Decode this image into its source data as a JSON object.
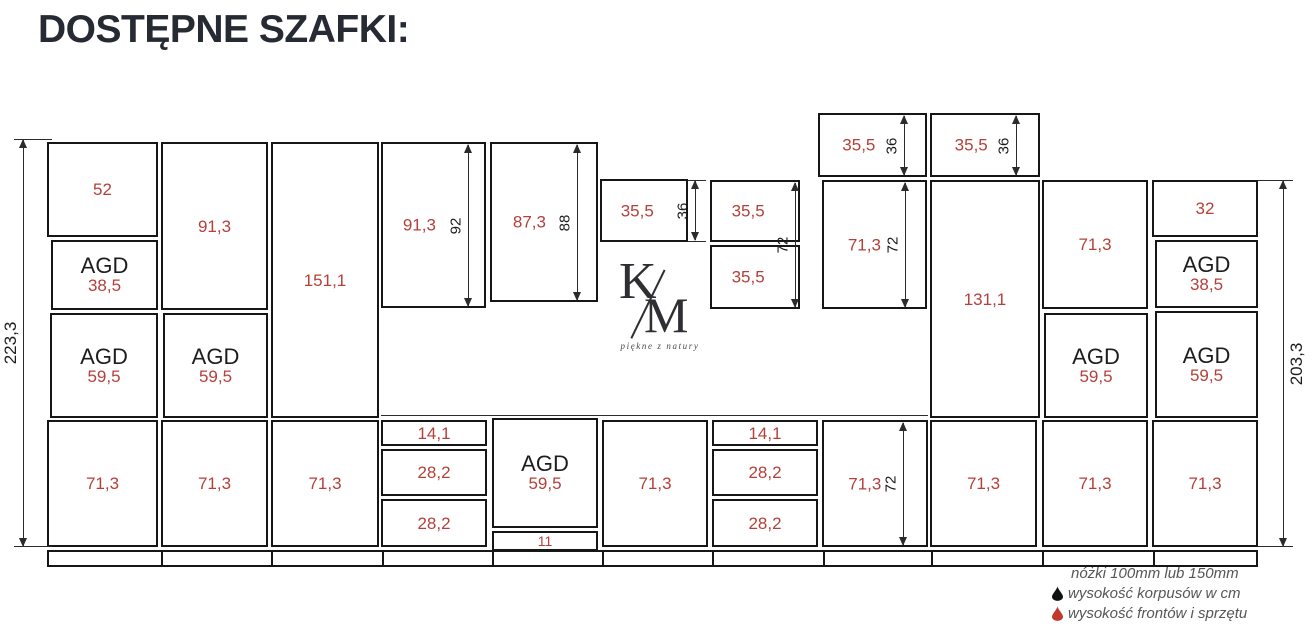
{
  "title": "DOSTĘPNE SZAFKI:",
  "colors": {
    "value_red": "#b5403a",
    "line_black": "#161616",
    "title_color": "#262a33",
    "legend_gray": "#565656",
    "legend_drop_black": "#111111",
    "legend_drop_red": "#c0392b"
  },
  "logo": {
    "k": "K",
    "m": "M",
    "tagline": "piękne z natury"
  },
  "legend": {
    "line1": "nóżki 100mm lub 150mm",
    "line2": "wysokość korpusów w cm",
    "line3": "wysokość frontów i sprzętu"
  },
  "diagram": {
    "agd_label": "AGD",
    "boxes": [
      {
        "x": 47,
        "y": 142,
        "w": 111,
        "h": 95,
        "v": "52"
      },
      {
        "x": 51,
        "y": 240,
        "w": 107,
        "h": 70,
        "agd": true,
        "v": "38,5"
      },
      {
        "x": 50,
        "y": 313,
        "w": 108,
        "h": 105,
        "agd": true,
        "v": "59,5"
      },
      {
        "x": 161,
        "y": 142,
        "w": 107,
        "h": 168,
        "v": "91,3"
      },
      {
        "x": 163,
        "y": 313,
        "w": 105,
        "h": 105,
        "agd": true,
        "v": "59,5"
      },
      {
        "x": 271,
        "y": 142,
        "w": 108,
        "h": 276,
        "v": "151,1"
      },
      {
        "x": 381,
        "y": 142,
        "w": 105,
        "h": 166,
        "v": "91,3",
        "vx": 0.36
      },
      {
        "x": 490,
        "y": 142,
        "w": 108,
        "h": 160,
        "v": "87,3",
        "vx": 0.36
      },
      {
        "x": 600,
        "y": 179,
        "w": 88,
        "h": 63,
        "v": "35,5",
        "vx": 0.42
      },
      {
        "x": 710,
        "y": 180,
        "w": 90,
        "h": 62,
        "v": "35,5",
        "vx": 0.42
      },
      {
        "x": 710,
        "y": 245,
        "w": 90,
        "h": 64,
        "v": "35,5",
        "vx": 0.42
      },
      {
        "x": 822,
        "y": 180,
        "w": 105,
        "h": 129,
        "v": "71,3",
        "vx": 0.4
      },
      {
        "x": 818,
        "y": 113,
        "w": 109,
        "h": 64,
        "v": "35,5",
        "vx": 0.37
      },
      {
        "x": 930,
        "y": 113,
        "w": 110,
        "h": 64,
        "v": "35,5",
        "vx": 0.37
      },
      {
        "x": 930,
        "y": 180,
        "w": 110,
        "h": 238,
        "v": "131,1"
      },
      {
        "x": 1042,
        "y": 180,
        "w": 106,
        "h": 129,
        "v": "71,3"
      },
      {
        "x": 1044,
        "y": 313,
        "w": 104,
        "h": 105,
        "agd": true,
        "v": "59,5"
      },
      {
        "x": 1152,
        "y": 180,
        "w": 106,
        "h": 57,
        "v": "32"
      },
      {
        "x": 1155,
        "y": 240,
        "w": 103,
        "h": 68,
        "agd": true,
        "v": "38,5"
      },
      {
        "x": 1155,
        "y": 311,
        "w": 103,
        "h": 107,
        "agd": true,
        "v": "59,5"
      },
      {
        "x": 47,
        "y": 420,
        "w": 111,
        "h": 127,
        "v": "71,3"
      },
      {
        "x": 161,
        "y": 420,
        "w": 107,
        "h": 127,
        "v": "71,3"
      },
      {
        "x": 271,
        "y": 420,
        "w": 108,
        "h": 127,
        "v": "71,3"
      },
      {
        "x": 381,
        "y": 420,
        "w": 106,
        "h": 26,
        "v": "14,1"
      },
      {
        "x": 381,
        "y": 449,
        "w": 106,
        "h": 47,
        "v": "28,2"
      },
      {
        "x": 381,
        "y": 499,
        "w": 106,
        "h": 48,
        "v": "28,2"
      },
      {
        "x": 492,
        "y": 418,
        "w": 106,
        "h": 110,
        "agd": true,
        "v": "59,5"
      },
      {
        "x": 492,
        "y": 531,
        "w": 106,
        "h": 20,
        "v": "11",
        "small": true
      },
      {
        "x": 602,
        "y": 420,
        "w": 106,
        "h": 127,
        "v": "71,3"
      },
      {
        "x": 712,
        "y": 420,
        "w": 106,
        "h": 26,
        "v": "14,1"
      },
      {
        "x": 712,
        "y": 449,
        "w": 106,
        "h": 47,
        "v": "28,2"
      },
      {
        "x": 712,
        "y": 499,
        "w": 106,
        "h": 48,
        "v": "28,2"
      },
      {
        "x": 822,
        "y": 420,
        "w": 106,
        "h": 127,
        "v": "71,3",
        "vx": 0.4
      },
      {
        "x": 930,
        "y": 420,
        "w": 107,
        "h": 127,
        "v": "71,3"
      },
      {
        "x": 1042,
        "y": 420,
        "w": 106,
        "h": 127,
        "v": "71,3"
      },
      {
        "x": 1152,
        "y": 420,
        "w": 106,
        "h": 127,
        "v": "71,3"
      }
    ],
    "vdims": [
      {
        "x": 23,
        "y1": 140,
        "y2": 546,
        "label": "223,3",
        "side": "left",
        "big": true
      },
      {
        "x": 1283,
        "y1": 181,
        "y2": 546,
        "label": "203,3",
        "side": "right",
        "big": true
      },
      {
        "x": 468,
        "y1": 145,
        "y2": 306,
        "label": "92",
        "side": "left"
      },
      {
        "x": 577,
        "y1": 145,
        "y2": 300,
        "label": "88",
        "side": "left"
      },
      {
        "x": 695,
        "y1": 181,
        "y2": 240,
        "label": "36",
        "side": "left"
      },
      {
        "x": 795,
        "y1": 183,
        "y2": 307,
        "label": "72",
        "side": "left"
      },
      {
        "x": 905,
        "y1": 183,
        "y2": 307,
        "label": "72",
        "side": "left"
      },
      {
        "x": 904,
        "y1": 116,
        "y2": 175,
        "label": "36",
        "side": "left"
      },
      {
        "x": 1016,
        "y1": 116,
        "y2": 175,
        "label": "36",
        "side": "left"
      },
      {
        "x": 903,
        "y1": 423,
        "y2": 545,
        "label": "72",
        "side": "left"
      }
    ],
    "hlines": [
      {
        "x1": 14,
        "x2": 52,
        "y": 139
      },
      {
        "x1": 14,
        "x2": 52,
        "y": 546
      },
      {
        "x1": 1258,
        "x2": 1293,
        "y": 180
      },
      {
        "x1": 1258,
        "x2": 1293,
        "y": 546
      },
      {
        "x1": 381,
        "x2": 928,
        "y": 415
      },
      {
        "x1": 688,
        "x2": 706,
        "y": 180
      },
      {
        "x1": 688,
        "x2": 706,
        "y": 241
      }
    ],
    "plinth": {
      "x": 47,
      "y": 550,
      "w": 1211,
      "h": 17,
      "dividers": [
        159,
        269,
        380,
        490,
        600,
        710,
        821,
        929,
        1040,
        1151
      ]
    }
  }
}
